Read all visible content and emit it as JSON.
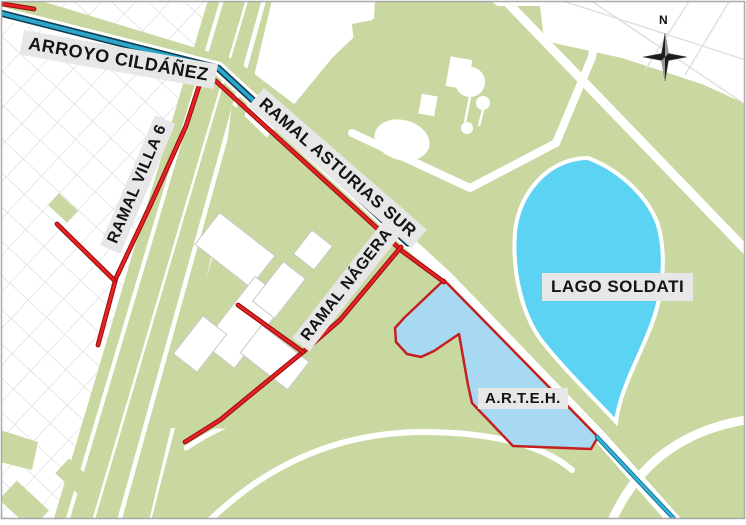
{
  "map": {
    "labels": {
      "arroyo_cildanez": "ARROYO CILDÁÑEZ",
      "ramal_asturias_sur": "RAMAL ASTURIAS SUR",
      "ramal_villa_6": "RAMAL VILLA 6",
      "ramal_nagera": "RAMAL NÁGERA",
      "lago_soldati": "LAGO SOLDATI",
      "arteh": "A.R.T.E.H.",
      "compass_north": "N"
    },
    "colors": {
      "stream_line": "#2aa7cb",
      "stream_casing": "#123f55",
      "branch_red": "#e82222",
      "branch_red_casing": "#991111",
      "lake_fill": "#5cd3f3",
      "arteh_fill": "#a7daf2",
      "arteh_border": "#c42020",
      "park_green": "#c9d7a0",
      "street_grid": "#d9d9d9",
      "label_background": "#e7e7e7",
      "label_text": "#141414",
      "map_border": "#a9a9a9"
    }
  }
}
